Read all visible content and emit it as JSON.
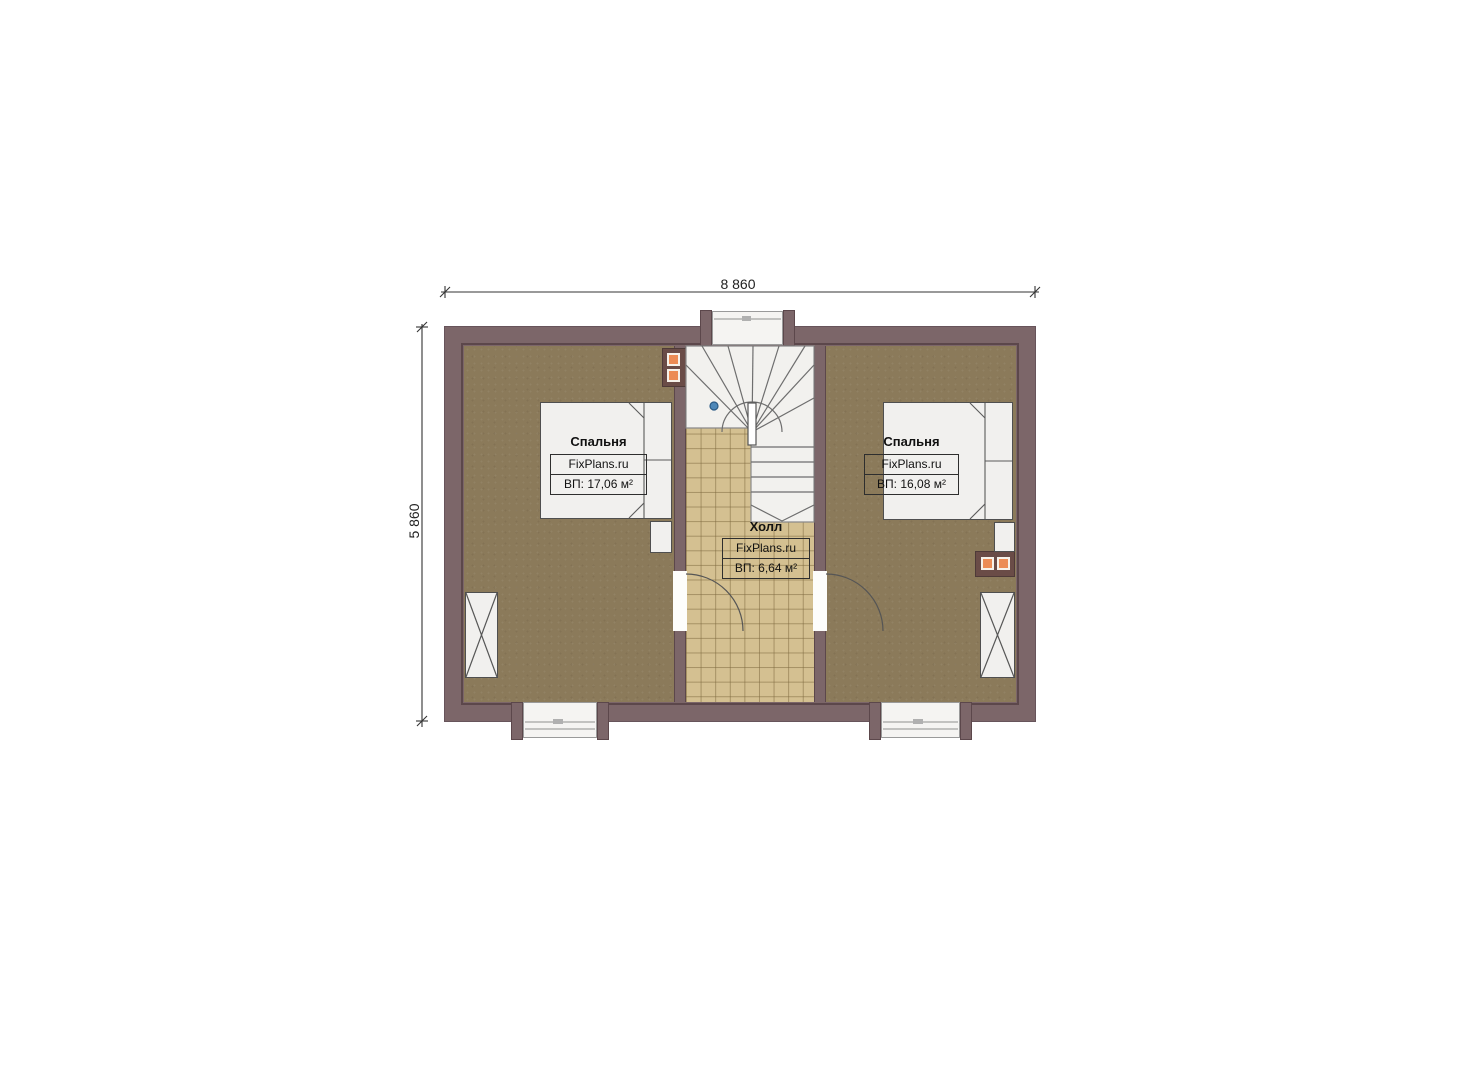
{
  "plan": {
    "dimensions": {
      "width": "8 860",
      "height": "5 860"
    },
    "rooms": {
      "bedroom_left": {
        "name": "Спальня",
        "brand": "FixPlans.ru",
        "area": "ВП: 17,06 м²"
      },
      "bedroom_right": {
        "name": "Спальня",
        "brand": "FixPlans.ru",
        "area": "ВП: 16,08 м²"
      },
      "hall": {
        "name": "Холл",
        "brand": "FixPlans.ru",
        "area": "ВП: 6,64 м²"
      }
    },
    "colors": {
      "wall": "#7c6669",
      "wall_outline": "#5c474b",
      "bedroom_floor": "#8b7a5a",
      "hall_floor": "#d4c091",
      "stair": "#f2f1ee",
      "furn": "#f1f0ee",
      "furn_line": "#4f4f4f",
      "flue": "#6a4c47",
      "accent_orange": "#ec8c55",
      "dim_line": "#333333",
      "label_text": "#111111"
    }
  }
}
